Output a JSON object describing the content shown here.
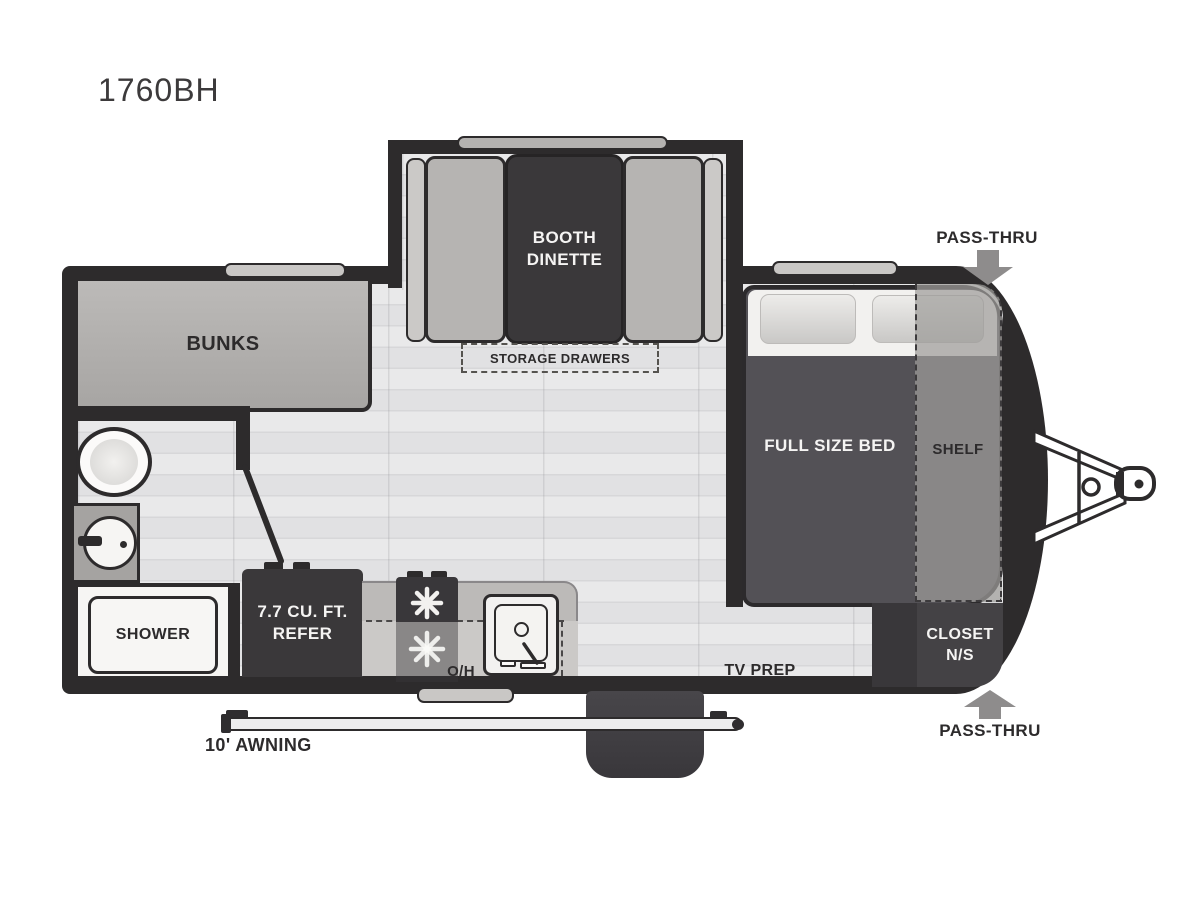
{
  "title": "1760BH",
  "labels": {
    "bunks": "BUNKS",
    "booth_dinette_line1": "BOOTH",
    "booth_dinette_line2": "DINETTE",
    "storage_drawers": "STORAGE DRAWERS",
    "full_size_bed": "FULL SIZE BED",
    "shelf": "SHELF",
    "closet_line1": "CLOSET",
    "closet_line2": "N/S",
    "shower": "SHOWER",
    "refer_line1": "7.7 CU. FT.",
    "refer_line2": "REFER",
    "overhead": "O/H",
    "tv_prep": "TV PREP",
    "pass_thru_top": "PASS-THRU",
    "pass_thru_bottom": "PASS-THRU",
    "awning": "10' AWNING"
  },
  "colors": {
    "wall": "#2d2b2c",
    "floor": "#e6e6e7",
    "fixture_dark": "#3a383a",
    "bed": "#535156",
    "cushion_gray": "#b6b4b2",
    "shelf_overlay": "#9e9c9a",
    "closet": "#444245",
    "arrow_gray": "#8e8c8c"
  },
  "icons": {
    "pass_thru_arrow": "solid gray arrow",
    "hitch": "A-frame tongue with coupler",
    "toilet": "oval toilet bowl",
    "bath_sink": "round basin with faucet",
    "kitchen_sink": "square basin with faucet",
    "stove_burner": "white starburst burner",
    "door_swing": "diagonal open door line",
    "window": "wall window bar",
    "entry_step": "entry step pad",
    "awning_bar": "awning rail"
  }
}
